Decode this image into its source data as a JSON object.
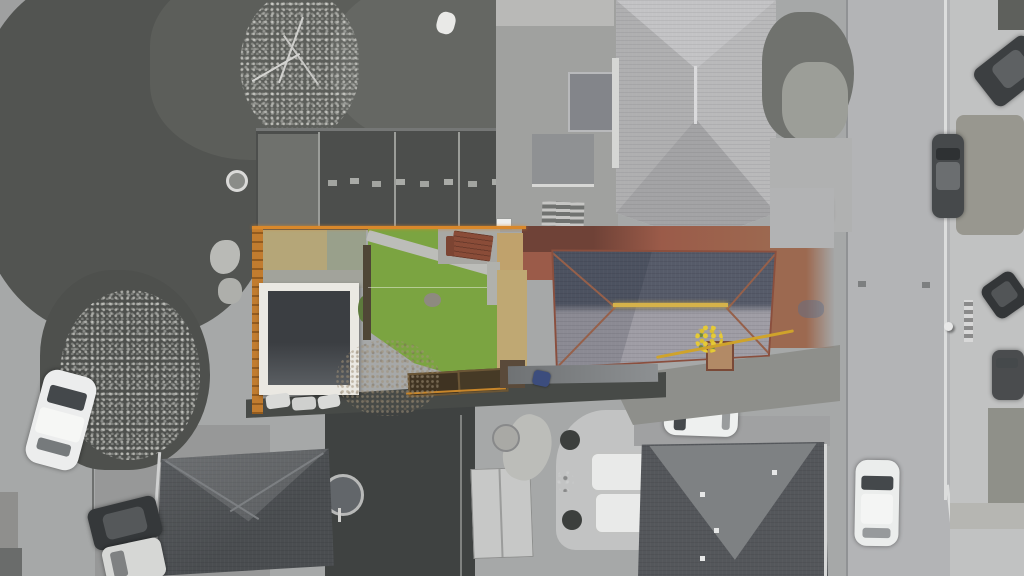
{
  "scene": {
    "type": "aerial-drone-photograph",
    "style": "grayscale surroundings with the subject property highlighted in colour",
    "highlighted_plot": {
      "features": [
        "orange boundary fence",
        "tan patio",
        "flat-roof garage with white edging",
        "green lawn with diagonal path",
        "picnic table patio",
        "timber planters",
        "hipped slate roof house with lichen ridge",
        "chimney",
        "rust brick driveway",
        "yellow hose"
      ],
      "boundary_color": "#d9882b"
    },
    "surroundings": [
      "dense tree canopy",
      "neighbouring rear gardens with fence panels",
      "large grey hipped-roof house",
      "vertical road with kerb lines",
      "pavement with parked cars",
      "three grey roofed houses at bottom",
      "garden patio with white furniture",
      "white shed",
      "satellite-dish/rotary-line circle"
    ],
    "vehicles": [
      "white car on left road",
      "dark car and white van bottom-left",
      "white car on top driveway",
      "white car on lower driveway",
      "white car driving on road",
      "dark car parked on road edge",
      "dark car angled top-right",
      "two dark cars right pavement",
      "small blue bin/car by house wall",
      "white cars cluster below garage"
    ]
  },
  "palette": {
    "pavement": "#a6a8a8",
    "road": "#b3b4b6",
    "kerb_white": "#dcdddd",
    "tree_dark": "#525451",
    "garden_dark": "#4c4e4c",
    "lawn_green": "#7ba441",
    "patio_tan": "#b5a678",
    "patio_olive": "#99a08b",
    "concrete_grey": "#a2a39b",
    "garage_frame": "#eae8e2",
    "garage_roof": "#3b3e42",
    "fence_orange": "#c17c2f",
    "boundary_orange": "#d9882b",
    "brick_red": "#9b5b49",
    "brick_dark": "#6f4237",
    "rust_drive": "#9c6950",
    "roof_slate_dark": "#565b69",
    "roof_slate_light": "#9f9da5",
    "roof_hip_terracotta": "#96604a",
    "ridge_lichen": "#d5b24a",
    "grey_roof_light": "#c3c3c5",
    "dark_roof_grey": "#54575b",
    "shed_grey": "#8f9193",
    "patio_light": "#c2c3c3",
    "car_white": "#eceded",
    "car_dark": "#3f4244",
    "bin_blue": "#3c4d7d",
    "hose_yellow": "#cfa32b"
  }
}
